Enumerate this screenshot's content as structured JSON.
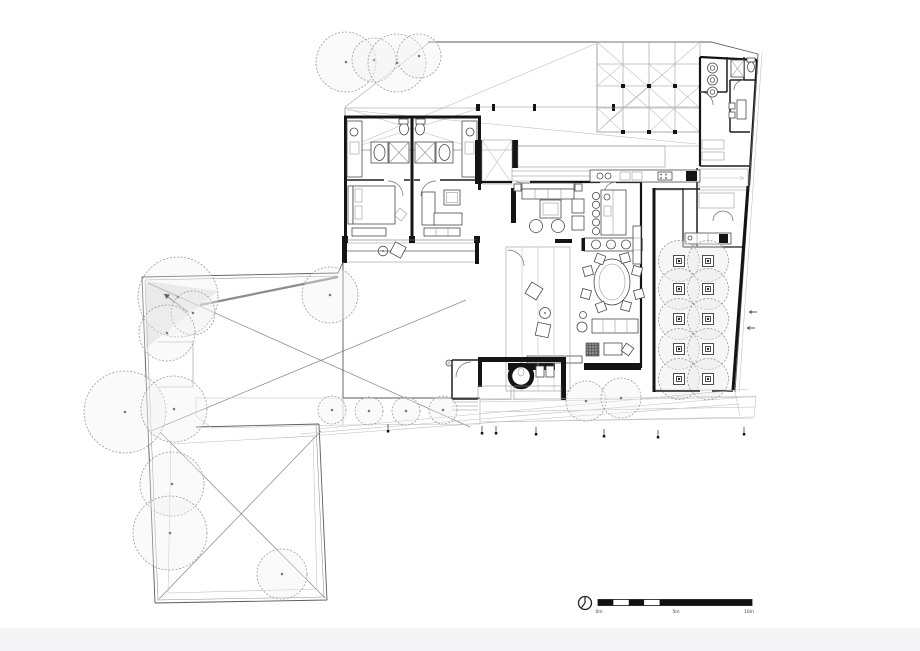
{
  "colors": {
    "wall": "#141414",
    "line_medium": "#555555",
    "line_light": "#9a9a9a",
    "deck_fill": "#e4e4e4",
    "garden_fill": "#dcdcdc",
    "drive_fill": "#efefef",
    "shade_fill": "#e3e3e3",
    "footer_band": "#f5f5f7",
    "paper": "#ffffff"
  },
  "legend": {
    "north_icon": "north-arrow-icon",
    "scale_labels": [
      "0m",
      "5m",
      "10m"
    ],
    "scale_bar": {
      "x": 598,
      "y": 599.5,
      "w": 154,
      "h": 6,
      "split": 0.5,
      "checker_segments": 5
    }
  },
  "plan": {
    "tree_groups": [
      {
        "id": "g-top-trees",
        "items": [
          [
            346,
            62,
            30
          ],
          [
            374,
            60,
            22
          ],
          [
            397,
            63,
            29
          ],
          [
            419,
            56,
            22
          ]
        ]
      },
      {
        "id": "g-left-trees",
        "items": [
          [
            178,
            297,
            40
          ],
          [
            193,
            313,
            22
          ],
          [
            167,
            333,
            28
          ],
          [
            330,
            295,
            28
          ],
          [
            125,
            412,
            41
          ],
          [
            174,
            409,
            33
          ],
          [
            172,
            484,
            32
          ],
          [
            170,
            533,
            37
          ],
          [
            282,
            574,
            25
          ]
        ]
      },
      {
        "id": "g-driveway-trees",
        "items": [
          [
            332,
            410,
            14
          ],
          [
            369,
            411,
            14
          ],
          [
            406,
            411,
            14
          ],
          [
            443,
            410,
            14
          ]
        ]
      },
      {
        "id": "g-lower-trees",
        "items": [
          [
            586,
            401,
            20
          ],
          [
            621,
            398,
            20
          ]
        ]
      }
    ],
    "planter_grid": {
      "cols": [
        679,
        708
      ],
      "rows": [
        261,
        289,
        319,
        349,
        379
      ],
      "canopy_r": 20.5,
      "outer": 11,
      "inner": 5
    },
    "dining_chairs": [
      [
        600,
        259,
        20
      ],
      [
        625,
        258,
        -15
      ],
      [
        588,
        271,
        75
      ],
      [
        586,
        294,
        105
      ],
      [
        637,
        271,
        -75
      ],
      [
        639,
        294,
        -105
      ],
      [
        601,
        307,
        160
      ],
      [
        626,
        306,
        195
      ]
    ],
    "dining_chair_size": 9,
    "kitchen_stools": {
      "count": 5,
      "x": 596,
      "y0": 196,
      "dy": 8.8,
      "r": 3.6
    },
    "laundry_machines": {
      "count": 3,
      "x": 712.5,
      "y0": 68,
      "dy": 12,
      "r": 5
    }
  }
}
